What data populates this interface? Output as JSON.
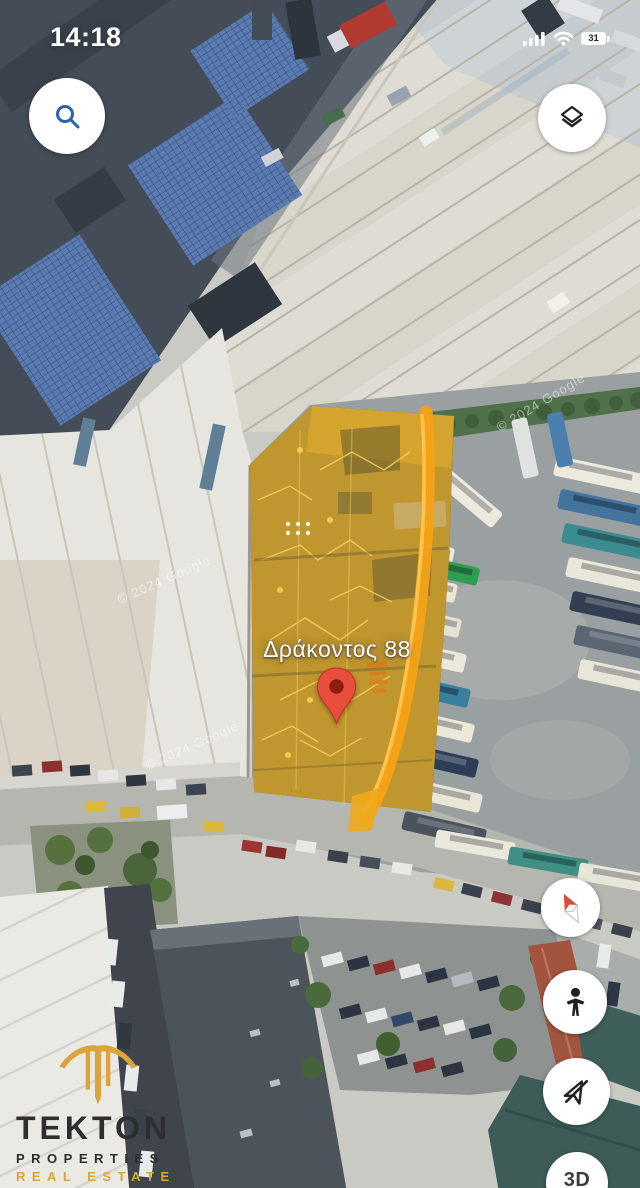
{
  "status_bar": {
    "time": "14:18",
    "battery_percent": "31",
    "icons": [
      "signal-bars",
      "wifi",
      "battery"
    ]
  },
  "map": {
    "address_label": "Δράκοντος 88",
    "copyright": "© 2024 Google",
    "marker": "red-map-pin",
    "highlighted_parcel": "yellow-overlay-polygon"
  },
  "controls": {
    "search_icon": "magnifier",
    "layers_icon": "stacked-layers",
    "compass_icon": "compass-needle",
    "street_view_icon": "pegman",
    "location_icon": "navigation-arrow-slashed",
    "three_d_label": "3D"
  },
  "branding": {
    "name": "TEKTON",
    "line2": "PROPERTIES",
    "line3": "REAL ESTATE"
  },
  "colors": {
    "parcel_highlight": "#e2a928",
    "parcel_stripe": "#f5a217",
    "pin_red": "#e94e3c",
    "brand_gold": "#d9a53c",
    "search_icon_blue": "#2c63ad"
  }
}
